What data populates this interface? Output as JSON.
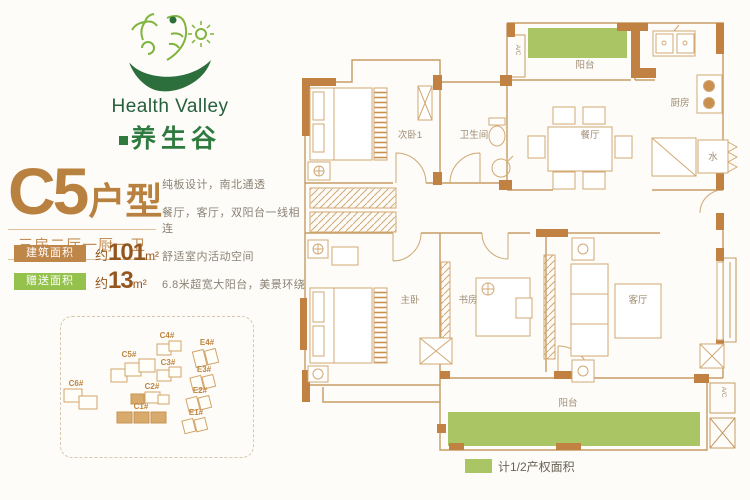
{
  "logo": {
    "en": "Health Valley",
    "cn": "养生谷"
  },
  "unit": {
    "code": "C5",
    "type_suffix": "户型",
    "subtitle": "三房二厅一厨一卫",
    "area_badges": [
      {
        "label": "建筑面积",
        "prefix": "约",
        "value": "101",
        "unit": "m²"
      },
      {
        "label": "赠送面积",
        "prefix": "约",
        "value": "13",
        "unit": "m²"
      }
    ],
    "description_lines": [
      "纯板设计，南北通透",
      "餐厅，客厅，双阳台一线相连",
      "舒适室内活动空间",
      "6.8米超宽大阳台，美景环绕"
    ]
  },
  "site_plan": {
    "buildings": [
      {
        "label": "C6#"
      },
      {
        "label": "C5#"
      },
      {
        "label": "C4#"
      },
      {
        "label": "C3#"
      },
      {
        "label": "C2#"
      },
      {
        "label": "C1#"
      },
      {
        "label": "E4#"
      },
      {
        "label": "E3#"
      },
      {
        "label": "E2#"
      },
      {
        "label": "E1#"
      }
    ]
  },
  "floor_plan": {
    "rooms": {
      "balcony_top": "阳台",
      "kitchen": "厨房",
      "dining": "餐厅",
      "bedroom2": "次卧1",
      "bathroom": "卫生间",
      "master": "主卧",
      "study": "书房",
      "living": "客厅",
      "balcony_bottom": "阳台",
      "water": "水",
      "ac": "A/C"
    },
    "legend_label": "计1/2产权面积"
  },
  "colors": {
    "wall_tan": "#c08143",
    "outline_tan": "#c69b63",
    "area_green": "#a9c564",
    "badge_tan": "#bf8649",
    "badge_green": "#94c24d",
    "title_bronze": "#b9813f",
    "logo_green": "#2e7a3f"
  }
}
